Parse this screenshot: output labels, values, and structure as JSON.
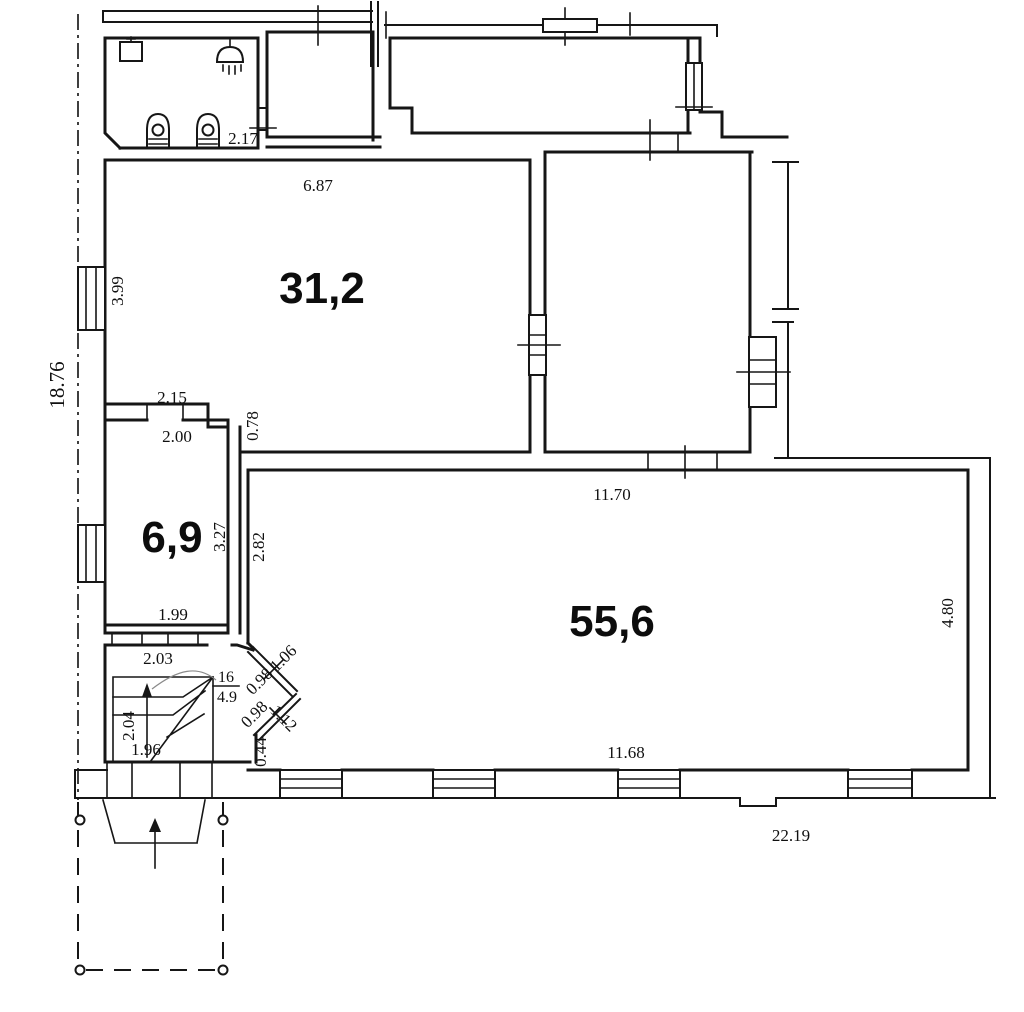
{
  "plan": {
    "areas": {
      "room31": "31,2",
      "room6": "6,9",
      "room55": "55,6"
    },
    "stair": {
      "number": "16",
      "area": "4.9"
    },
    "dimensions": {
      "overall_left": "18.76",
      "overall_bottom": "22.19",
      "bath_width": "2.17",
      "room31_width": "6.87",
      "room31_height": "3.99",
      "lobby_width": "2.15",
      "room6_top_width": "2.00",
      "wall_step": "0.78",
      "room6_height": "3.27",
      "room6_bottom_width": "1.99",
      "room55_top_width": "11.70",
      "room55_left_height": "2.82",
      "room55_right_height": "4.80",
      "room55_bottom_width": "11.68",
      "stair_hall_width": "2.03",
      "bay_window1_outer": "1.06",
      "bay_window1_inner": "0.98",
      "bay_window2_inner": "0.98",
      "bay_window2_outer": "1.12",
      "bay_wall": "0.44",
      "stair_depth": "2.04",
      "stair_width": "1.96"
    }
  }
}
